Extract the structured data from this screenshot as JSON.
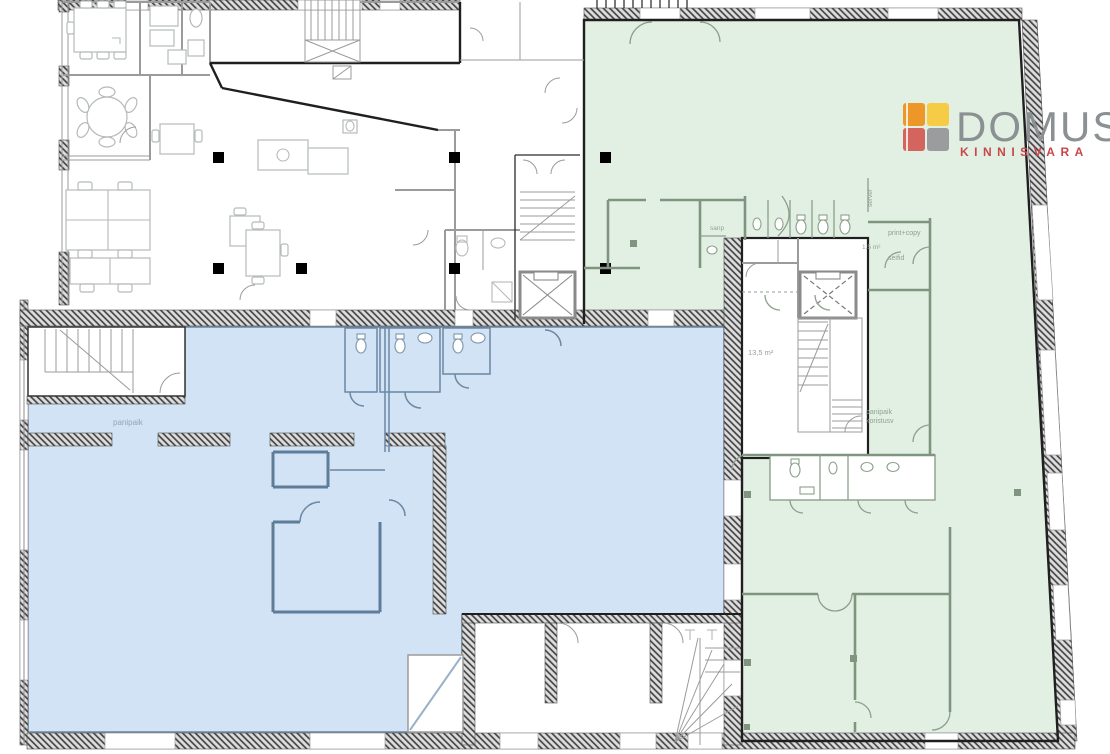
{
  "logo": {
    "brand": "DOMUS",
    "tagline": "KINNISVARA",
    "brand_color": "#8B9192",
    "tagline_color": "#C9474A",
    "mark": {
      "top_left": "#EC9728",
      "top_right": "#F6CB45",
      "bottom_left": "#D4645E",
      "bottom_right": "#9A9C9E"
    }
  },
  "regions": {
    "green": {
      "name": "green highlighted premises",
      "fill": "#E2F0E3"
    },
    "blue": {
      "name": "blue highlighted premises",
      "fill": "#D1E3F5"
    }
  },
  "labels": {
    "panipaik_blue": {
      "text": "panipaik"
    },
    "sanp": {
      "text": "sanp"
    },
    "server": {
      "text": "server"
    },
    "print_copy": {
      "text": "print+copy"
    },
    "area_1_5": {
      "text": "1,5 m²"
    },
    "seifid": {
      "text": "seifid"
    },
    "area_13_5": {
      "text": "13,5 m²"
    },
    "panipaik_line1": {
      "text": "panipaik"
    },
    "panipaik_line2": {
      "text": "koristusv"
    }
  }
}
